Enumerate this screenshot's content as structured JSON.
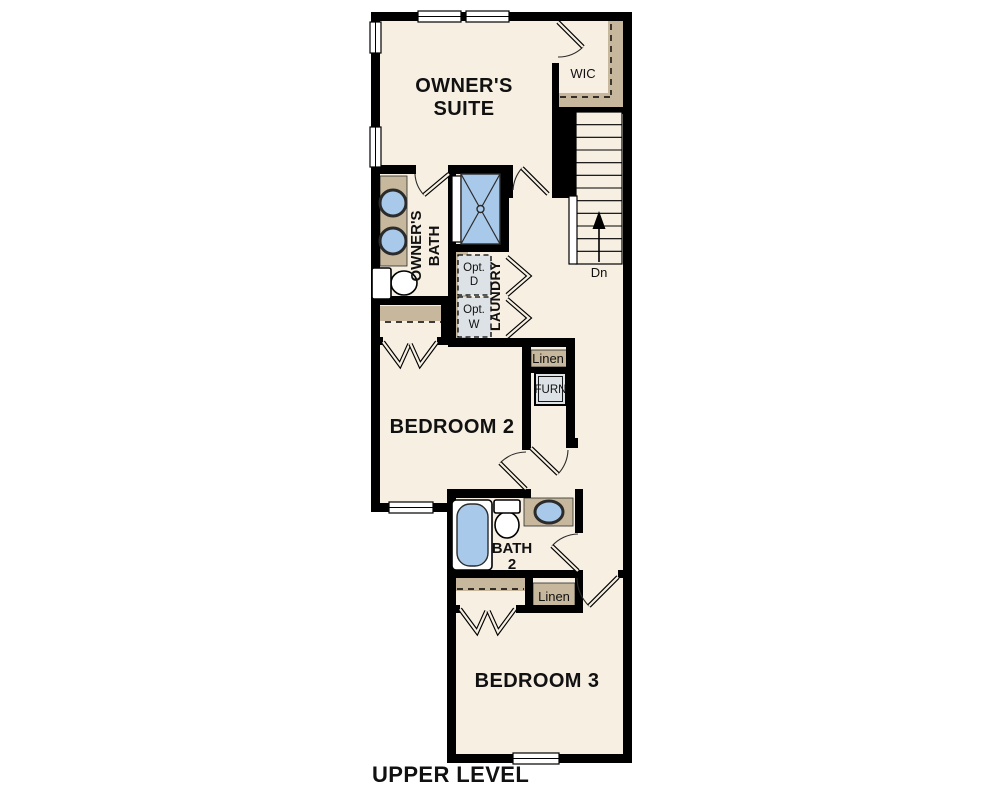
{
  "title": "UPPER LEVEL",
  "colors": {
    "floor": "#f6efe2",
    "wall": "#000000",
    "line": "#2b2b2b",
    "tan": "#c7b89d",
    "blue": "#a8c9ea",
    "gray": "#dde2e6",
    "text": "#111111"
  },
  "labels": {
    "owners_suite_1": "OWNER'S",
    "owners_suite_2": "SUITE",
    "wic": "WIC",
    "dn": "Dn",
    "owners_bath_1": "OWNER'S",
    "owners_bath_2": "BATH",
    "opt_d_1": "Opt.",
    "opt_d_2": "D",
    "opt_w_1": "Opt.",
    "opt_w_2": "W",
    "laundry": "LAUNDRY",
    "linen_hall": "Linen",
    "furn": "FURN",
    "bedroom2": "BEDROOM 2",
    "bath2_1": "BATH",
    "bath2_2": "2",
    "linen_bath": "Linen",
    "bedroom3": "BEDROOM 3"
  }
}
